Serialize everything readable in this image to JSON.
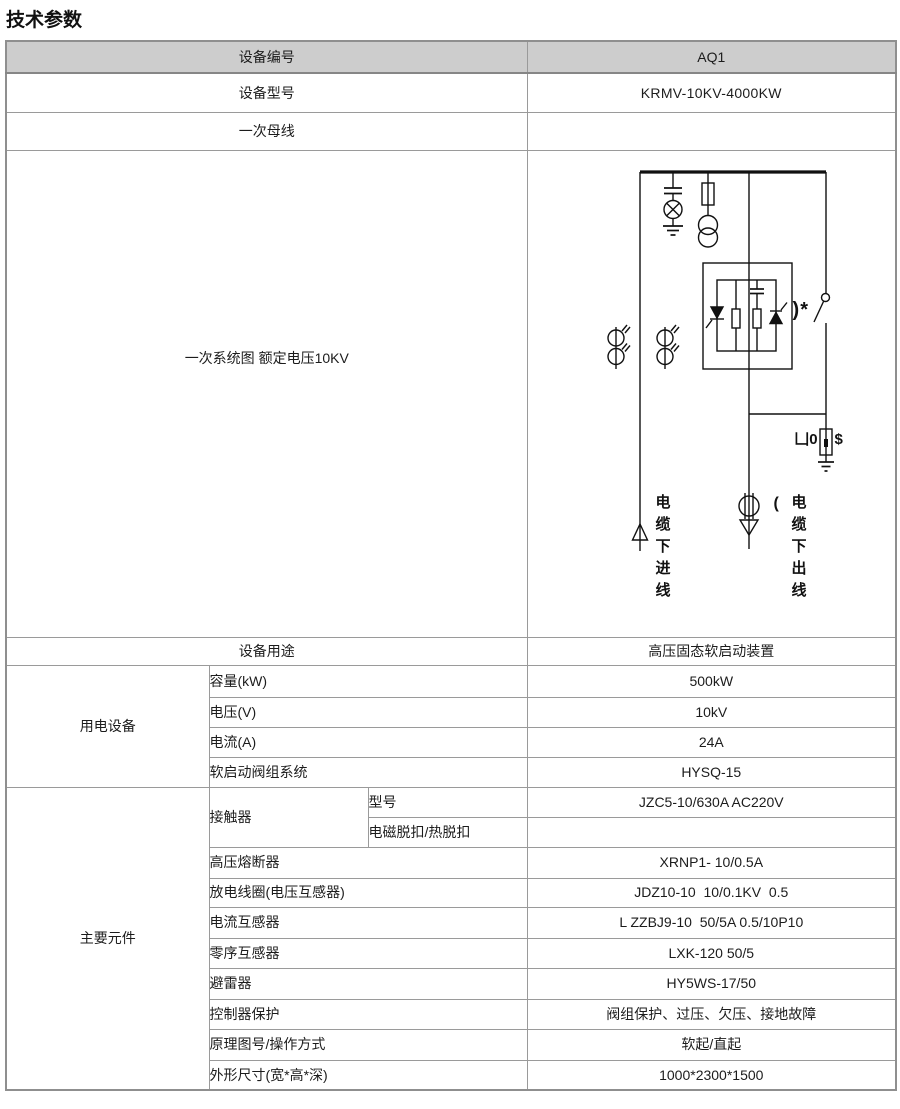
{
  "page": {
    "title": "技术参数"
  },
  "table": {
    "header": {
      "label": "设备编号",
      "value": "AQ1"
    },
    "rows_top": [
      {
        "label": "设备型号",
        "value": "KRMV-10KV-4000KW"
      },
      {
        "label": "一次母线",
        "value": ""
      }
    ],
    "diagram_row": {
      "label": "一次系统图 额定电压10KV"
    },
    "purpose_row": {
      "label": "设备用途",
      "value": "高压固态软启动装置"
    },
    "groups": [
      {
        "name": "用电设备",
        "items": [
          {
            "label": "容量(kW)",
            "value": "500kW"
          },
          {
            "label": "电压(V)",
            "value": "10kV"
          },
          {
            "label": "电流(A)",
            "value": "24A"
          },
          {
            "label": "软启动阀组系统",
            "value": "HYSQ-15"
          }
        ]
      },
      {
        "name": "主要元件",
        "contactor": {
          "label": "接触器",
          "sub_items": [
            {
              "label": "型号",
              "value": "JZC5-10/630A AC220V"
            },
            {
              "label": "电磁脱扣/热脱扣",
              "value": ""
            }
          ]
        },
        "items": [
          {
            "label": "高压熔断器",
            "value": "XRNP1- 10/0.5A"
          },
          {
            "label": "放电线圈(电压互感器)",
            "value": "JDZ10-10  10/0.1KV  0.5"
          },
          {
            "label": "电流互感器",
            "value": "L ZZBJ9-10  50/5A 0.5/10P10"
          },
          {
            "label": "零序互感器",
            "value": "LXK-120 50/5"
          },
          {
            "label": "避雷器",
            "value": "HY5WS-17/50"
          },
          {
            "label": "控制器保护",
            "value": "阀组保护、过压、欠压、接地故障"
          },
          {
            "label": "原理图号/操作方式",
            "value": "软起/直起"
          },
          {
            "label": "外形尺寸(宽*高*深)",
            "value": "1000*2300*1500"
          }
        ]
      }
    ]
  },
  "diagram": {
    "rated_note": "一次系统图 额定电压10KV",
    "incoming_label": "电缆下进线",
    "outgoing_paren": "(",
    "outgoing_label": "电缆下出线",
    "switch_mark": ")*",
    "arrester_left": "凵0",
    "arrester_right": "$",
    "line_color": "#111111",
    "header_bg": "#cdcdcd",
    "border_color": "#9a9a9a"
  }
}
